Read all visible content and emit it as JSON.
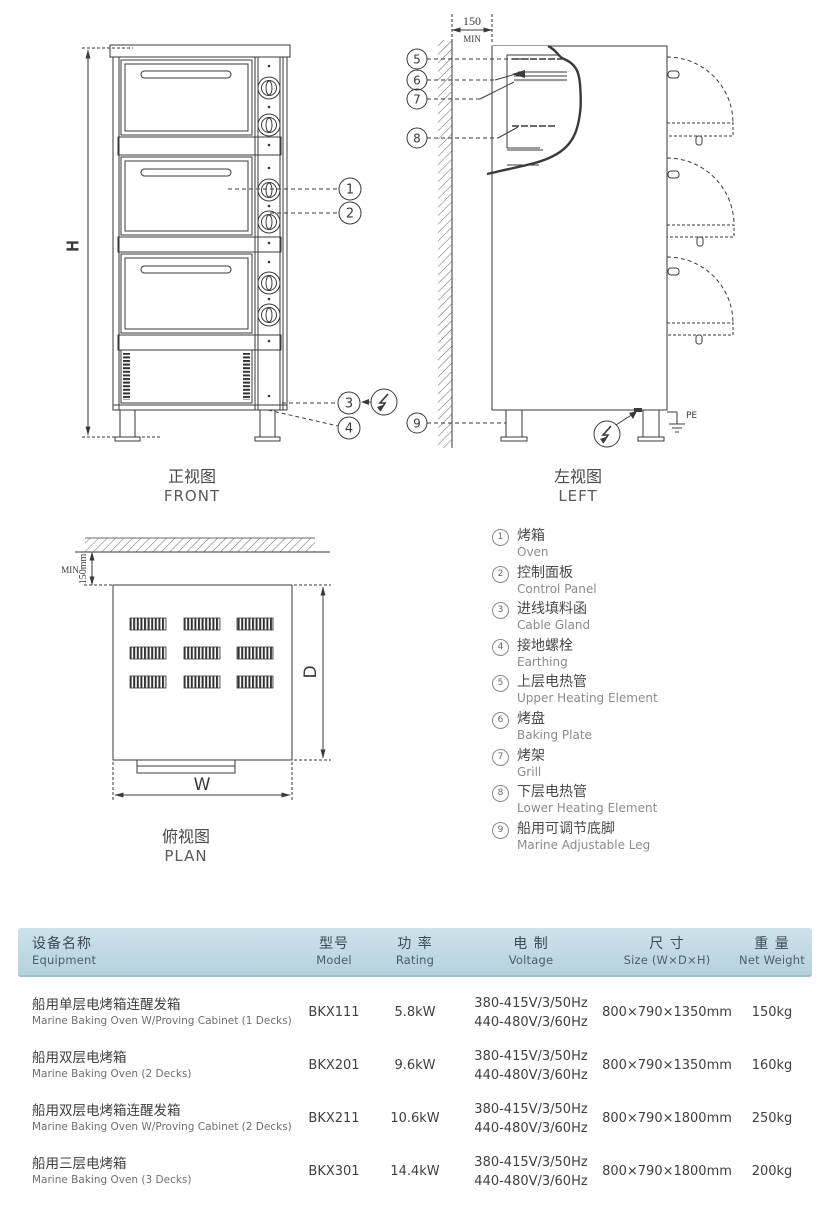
{
  "drawing": {
    "front": {
      "label_zh": "正视图",
      "label_en": "FRONT",
      "dim_height": "H"
    },
    "left": {
      "label_zh": "左视图",
      "label_en": "LEFT",
      "dim_clearance": "150",
      "dim_clearance_note": "MIN",
      "pe_label": "PE"
    },
    "plan": {
      "label_zh": "俯视图",
      "label_en": "PLAN",
      "dim_clearance": "150mm",
      "dim_clearance_note": "MIN",
      "dim_width": "W",
      "dim_depth": "D"
    },
    "callouts": {
      "c1": "1",
      "c2": "2",
      "c3": "3",
      "c4": "4",
      "c5": "5",
      "c6": "6",
      "c7": "7",
      "c8": "8",
      "c9": "9"
    }
  },
  "legend": {
    "items": [
      {
        "num": "1",
        "zh": "烤箱",
        "en": "Oven"
      },
      {
        "num": "2",
        "zh": "控制面板",
        "en": "Control Panel"
      },
      {
        "num": "3",
        "zh": "进线填料函",
        "en": "Cable Gland"
      },
      {
        "num": "4",
        "zh": "接地螺栓",
        "en": "Earthing"
      },
      {
        "num": "5",
        "zh": "上层电热管",
        "en": "Upper Heating Element"
      },
      {
        "num": "6",
        "zh": "烤盘",
        "en": "Baking Plate"
      },
      {
        "num": "7",
        "zh": "烤架",
        "en": "Grill"
      },
      {
        "num": "8",
        "zh": "下层电热管",
        "en": "Lower Heating Element"
      },
      {
        "num": "9",
        "zh": "船用可调节底脚",
        "en": "Marine Adjustable Leg"
      }
    ]
  },
  "spec_table": {
    "header_bg": "#bfd9e2",
    "headers": {
      "equipment_zh": "设备名称",
      "equipment_en": "Equipment",
      "model_zh": "型号",
      "model_en": "Model",
      "rating_zh": "功 率",
      "rating_en": "Rating",
      "voltage_zh": "电 制",
      "voltage_en": "Voltage",
      "size_zh": "尺 寸",
      "size_en": "Size (W×D×H)",
      "weight_zh": "重 量",
      "weight_en": "Net Weight"
    },
    "rows": [
      {
        "equipment_zh": "船用单层电烤箱连醒发箱",
        "equipment_en": "Marine Baking Oven W/Proving Cabinet (1 Decks)",
        "model": "BKX111",
        "rating": "5.8kW",
        "voltage_1": "380-415V/3/50Hz",
        "voltage_2": "440-480V/3/60Hz",
        "size": "800×790×1350mm",
        "weight": "150kg"
      },
      {
        "equipment_zh": "船用双层电烤箱",
        "equipment_en": "Marine Baking Oven (2 Decks)",
        "model": "BKX201",
        "rating": "9.6kW",
        "voltage_1": "380-415V/3/50Hz",
        "voltage_2": "440-480V/3/60Hz",
        "size": "800×790×1350mm",
        "weight": "160kg"
      },
      {
        "equipment_zh": "船用双层电烤箱连醒发箱",
        "equipment_en": "Marine Baking Oven W/Proving Cabinet (2 Decks)",
        "model": "BKX211",
        "rating": "10.6kW",
        "voltage_1": "380-415V/3/50Hz",
        "voltage_2": "440-480V/3/60Hz",
        "size": "800×790×1800mm",
        "weight": "250kg"
      },
      {
        "equipment_zh": "船用三层电烤箱",
        "equipment_en": "Marine Baking Oven (3 Decks)",
        "model": "BKX301",
        "rating": "14.4kW",
        "voltage_1": "380-415V/3/50Hz",
        "voltage_2": "440-480V/3/60Hz",
        "size": "800×790×1800mm",
        "weight": "200kg"
      }
    ]
  }
}
